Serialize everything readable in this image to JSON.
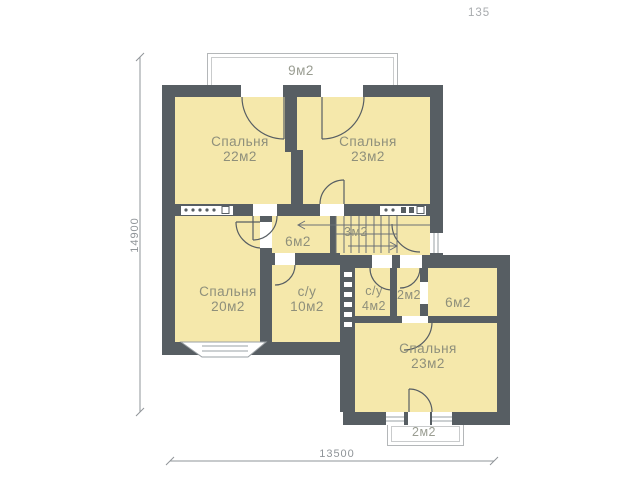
{
  "page": {
    "number": "135"
  },
  "floor_plan": {
    "rooms": {
      "bedroom_top_left": {
        "name": "Спальня",
        "area": "22м2"
      },
      "bedroom_top_right": {
        "name": "Спальня",
        "area": "23м2"
      },
      "bedroom_left": {
        "name": "Спальня",
        "area": "20м2"
      },
      "bedroom_bottom_right": {
        "name": "Спальня",
        "area": "23м2"
      },
      "bathroom_main": {
        "name": "с/у",
        "area": "10м2"
      },
      "bathroom_small": {
        "name": "с/у",
        "area": "4м2"
      },
      "hall": {
        "area": "6м2"
      },
      "stairs": {
        "area": "3м2"
      },
      "closet": {
        "area": "2м2"
      },
      "storage_right": {
        "area": "6м2"
      }
    },
    "balconies": {
      "top": {
        "area": "9м2"
      },
      "bottom": {
        "area": "2м2"
      }
    },
    "dimensions": {
      "vertical": "14900",
      "horizontal": "13500"
    },
    "colors": {
      "wall": "#575e63",
      "room_fill": "#f5e8ab",
      "label_text": "#8e8f7b",
      "dimension_color": "#8f9498"
    }
  }
}
